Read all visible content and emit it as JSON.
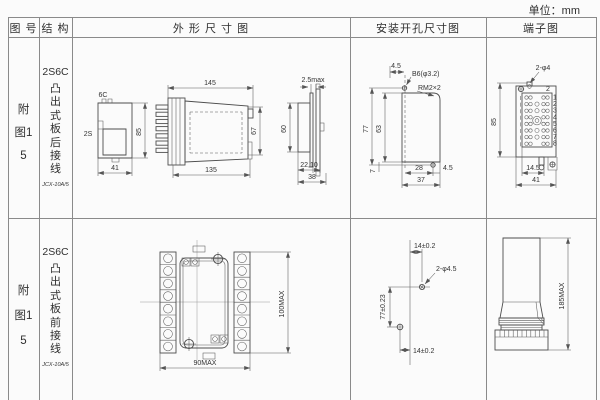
{
  "unit_label": "单位：mm",
  "header": {
    "fig_no": "图 号",
    "structure": "结 构",
    "outline": "外 形 尺 寸 图",
    "mounting": "安装开孔尺寸图",
    "terminal": "端子图"
  },
  "rows": [
    {
      "fig_no": "附图15",
      "structure": {
        "model": "2S6C",
        "mount_type": "凸出式板后接线",
        "socket_code": "JCX-10A/5"
      },
      "outline": {
        "bracket": {
          "top": "6C",
          "left": "2S",
          "height": "85",
          "width": "41"
        },
        "side": {
          "top": "145",
          "bottom": "135",
          "height": "67"
        },
        "rear": {
          "top": "2.5max",
          "height": "60",
          "inner": "22,10",
          "width": "38"
        }
      },
      "mounting": {
        "top": "4.5",
        "hole": "B6(φ3.2)",
        "thread": "RM2×2",
        "height_outer": "77",
        "height_inner": "63",
        "offset": "7",
        "width_inner": "28",
        "right": "4.5",
        "width_outer": "37"
      },
      "terminal": {
        "holes": "2-φ4",
        "corner": "2",
        "height": "85",
        "pitch": "14.5",
        "width": "41",
        "pins": [
          "1",
          "2",
          "3",
          "4",
          "5",
          "6",
          "7",
          "8"
        ]
      }
    },
    {
      "fig_no": "附图15",
      "structure": {
        "model": "2S6C",
        "mount_type": "凸出式板前接线",
        "socket_code": "JCX-10A/5"
      },
      "outline": {
        "width": "90MAX",
        "height": "100MAX"
      },
      "mounting": {
        "top": "14±0.2",
        "hole": "2-φ4.5",
        "height": "77±0.23",
        "bottom": "14±0.2"
      },
      "terminal": {
        "height": "185MAX"
      }
    }
  ]
}
